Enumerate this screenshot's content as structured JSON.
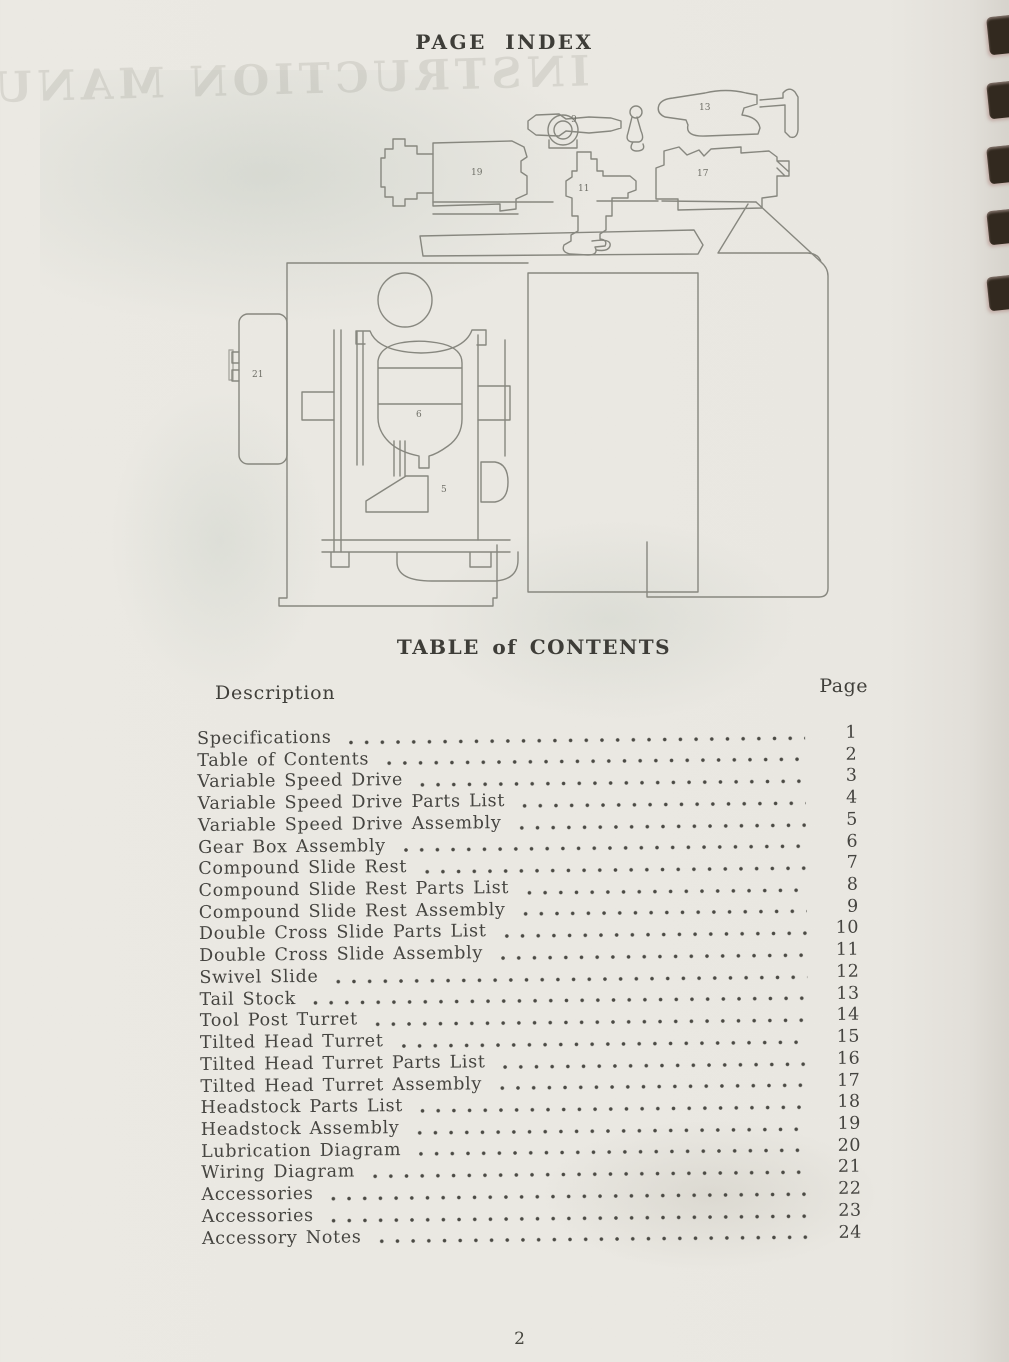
{
  "page": {
    "title": "PAGE INDEX",
    "footer_page_number": "2",
    "bleedthrough_text": "INSTRUCTION MANUAL"
  },
  "diagram": {
    "description": "turret lathe exploded line drawing with numbered part callouts",
    "callouts": [
      {
        "id": "part-9",
        "label": "9"
      },
      {
        "id": "part-13",
        "label": "13"
      },
      {
        "id": "part-19",
        "label": "19"
      },
      {
        "id": "part-11",
        "label": "11"
      },
      {
        "id": "part-17",
        "label": "17"
      },
      {
        "id": "part-21",
        "label": "21"
      },
      {
        "id": "part-6",
        "label": "6"
      },
      {
        "id": "part-5",
        "label": "5"
      }
    ]
  },
  "toc": {
    "heading": "TABLE of CONTENTS",
    "description_column_label": "Description",
    "page_column_label": "Page",
    "entries": [
      {
        "description": "Specifications",
        "page": "1"
      },
      {
        "description": "Table of Contents",
        "page": "2"
      },
      {
        "description": "Variable Speed Drive",
        "page": "3"
      },
      {
        "description": "Variable Speed Drive Parts List",
        "page": "4"
      },
      {
        "description": "Variable Speed Drive Assembly",
        "page": "5"
      },
      {
        "description": "Gear Box Assembly",
        "page": "6"
      },
      {
        "description": "Compound Slide Rest",
        "page": "7"
      },
      {
        "description": "Compound Slide Rest Parts List",
        "page": "8"
      },
      {
        "description": "Compound Slide Rest Assembly",
        "page": "9"
      },
      {
        "description": "Double Cross Slide Parts List",
        "page": "10"
      },
      {
        "description": "Double Cross Slide Assembly",
        "page": "11"
      },
      {
        "description": "Swivel Slide",
        "page": "12"
      },
      {
        "description": "Tail Stock",
        "page": "13"
      },
      {
        "description": "Tool Post Turret",
        "page": "14"
      },
      {
        "description": "Tilted Head Turret",
        "page": "15"
      },
      {
        "description": "Tilted Head Turret Parts List",
        "page": "16"
      },
      {
        "description": "Tilted Head Turret Assembly",
        "page": "17"
      },
      {
        "description": "Headstock Parts List",
        "page": "18"
      },
      {
        "description": "Headstock Assembly",
        "page": "19"
      },
      {
        "description": "Lubrication Diagram",
        "page": "20"
      },
      {
        "description": "Wiring Diagram",
        "page": "21"
      },
      {
        "description": "Accessories",
        "page": "22"
      },
      {
        "description": "Accessories",
        "page": "23"
      },
      {
        "description": "Accessory Notes",
        "page": "24"
      }
    ]
  }
}
